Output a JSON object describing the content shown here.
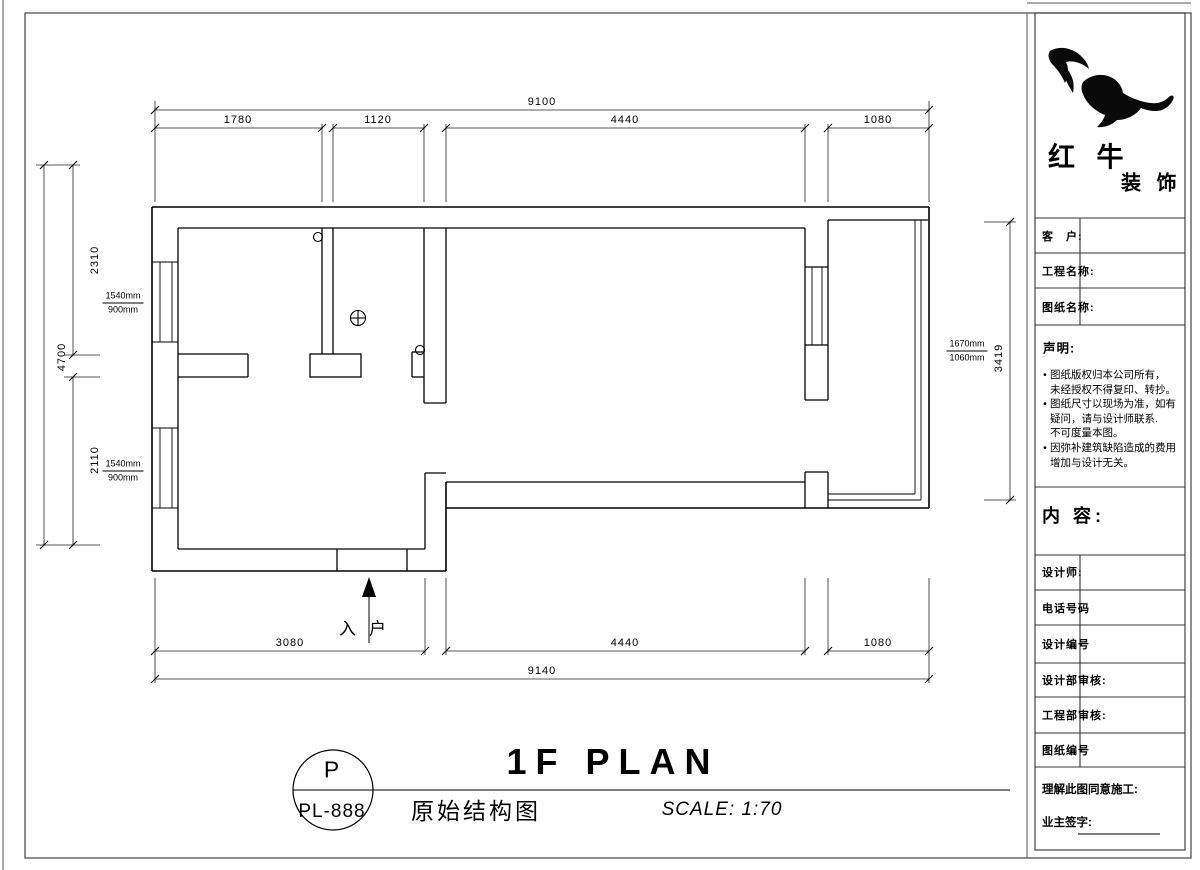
{
  "sheet": {
    "plan": {
      "entry_label": "入户"
    },
    "dimensions": {
      "top_total": "9100",
      "top_segments": [
        "1780",
        "1120",
        "4440",
        "1080"
      ],
      "bottom_segments": [
        "3080",
        "4440",
        "1080"
      ],
      "bottom_total": "9140",
      "left_total": "4700",
      "left_segments": [
        "2310",
        "2110"
      ],
      "right_height": "3419",
      "window_left_upper": {
        "w": "1540mm",
        "h": "900mm"
      },
      "window_left_lower": {
        "w": "1540mm",
        "h": "900mm"
      },
      "window_right": {
        "w": "1670mm",
        "h": "1060mm"
      }
    },
    "titleblock": {
      "ref_letter": "P",
      "ref_code": "PL-888",
      "title_en": "1F PLAN",
      "title_cn": "原始结构图",
      "scale": "SCALE: 1:70"
    },
    "sidebar": {
      "brand_top": "红 牛",
      "brand_bottom": "装 饰",
      "fields_top": [
        {
          "label": "客　户:"
        },
        {
          "label": "工程名称:"
        },
        {
          "label": "图纸名称:"
        }
      ],
      "declaration": {
        "title": "声明:",
        "lines": [
          {
            "bullet": "•",
            "text": "图纸版权归本公司所有，"
          },
          {
            "bullet": "",
            "text": "未经授权不得复印、转抄。"
          },
          {
            "bullet": "•",
            "text": "图纸尺寸以现场为准，如有"
          },
          {
            "bullet": "",
            "text": "疑问，请与设计师联系."
          },
          {
            "bullet": "",
            "text": "不可度量本图。"
          },
          {
            "bullet": "•",
            "text": "因弥补建筑缺陷造成的费用"
          },
          {
            "bullet": "",
            "text": "增加与设计无关。"
          }
        ]
      },
      "content_label": "内 容:",
      "fields_bottom": [
        {
          "label": "设计师:"
        },
        {
          "label": "电话号码"
        },
        {
          "label": "设计编号"
        },
        {
          "label": "设计部审核:"
        },
        {
          "label": "工程部审核:"
        },
        {
          "label": "图纸编号"
        }
      ],
      "footer": {
        "agree": "理解此图同意施工:",
        "sign": "业主签字:"
      }
    },
    "colors": {
      "line": "#000000",
      "paper": "#ffffff"
    }
  }
}
